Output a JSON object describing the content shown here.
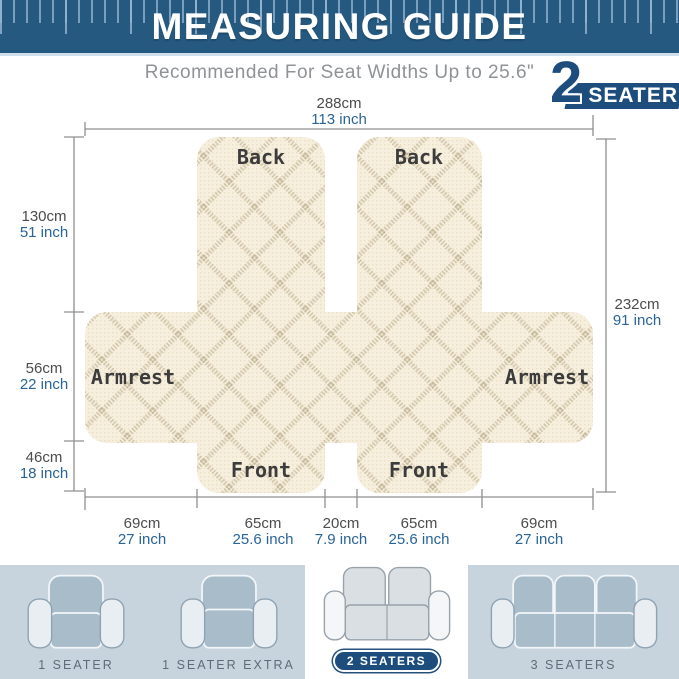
{
  "header": {
    "title": "MEASURING GUIDE"
  },
  "subtitle": "Recommended For Seat Widths Up to 25.6\"",
  "badge": {
    "number": "2",
    "label": "SEATER"
  },
  "diagram": {
    "panels": {
      "back": "Back",
      "armrest": "Armrest",
      "front": "Front"
    },
    "measurements": {
      "top": {
        "cm": "288cm",
        "inch": "113 inch"
      },
      "right": {
        "cm": "232cm",
        "inch": "91 inch"
      },
      "left": [
        {
          "cm": "130cm",
          "inch": "51 inch"
        },
        {
          "cm": "56cm",
          "inch": "22 inch"
        },
        {
          "cm": "46cm",
          "inch": "18 inch"
        }
      ],
      "bottom": [
        {
          "cm": "69cm",
          "inch": "27 inch"
        },
        {
          "cm": "65cm",
          "inch": "25.6 inch"
        },
        {
          "cm": "20cm",
          "inch": "7.9 inch"
        },
        {
          "cm": "65cm",
          "inch": "25.6 inch"
        },
        {
          "cm": "69cm",
          "inch": "27 inch"
        }
      ]
    }
  },
  "variants": [
    {
      "label": "1 SEATER",
      "selected": false
    },
    {
      "label": "1 SEATER EXTRA",
      "selected": false
    },
    {
      "label": "2 SEATERS",
      "selected": true
    },
    {
      "label": "3 SEATERS",
      "selected": false
    }
  ],
  "colors": {
    "header_blue": "#26597f",
    "badge_navy": "#1d4d7c",
    "inch_blue": "#2a6496",
    "cm_gray": "#4c4c4c",
    "fabric_cream": "#f7efdd",
    "footer_gray_blue": "#c7d4de"
  }
}
